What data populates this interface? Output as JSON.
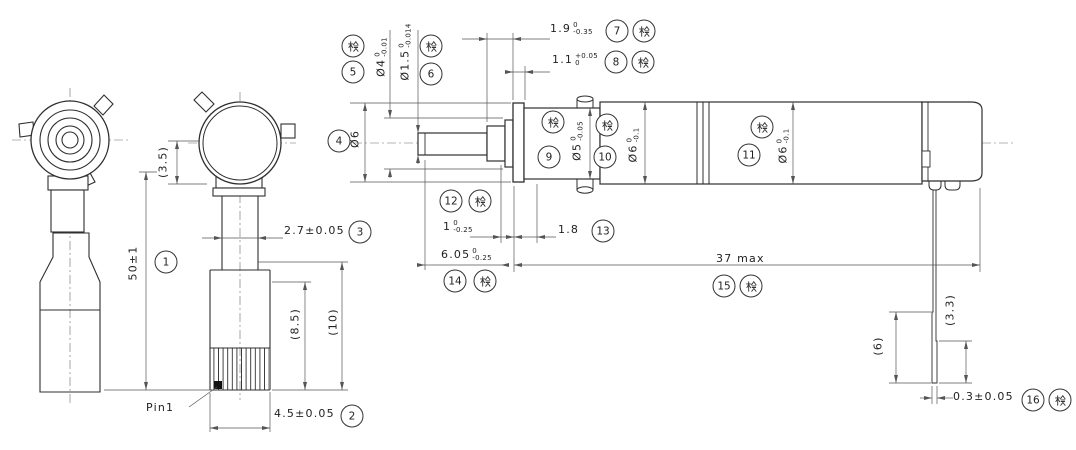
{
  "drawing": {
    "inspection_mark": "検",
    "pin_label": "Pin1",
    "dimensions": {
      "d1": {
        "balloon": "1",
        "value": "50±1"
      },
      "d2": {
        "balloon": "2",
        "value": "4.5±0.05"
      },
      "d3": {
        "balloon": "3",
        "value": "2.7±0.05"
      },
      "d4": {
        "balloon": "4",
        "value": "Ø6"
      },
      "d5": {
        "balloon": "5",
        "value": "Ø4",
        "tol_upper": "0",
        "tol_lower": "-0.01",
        "inspection": true
      },
      "d6": {
        "balloon": "6",
        "value": "Ø1.5",
        "tol_upper": "0",
        "tol_lower": "-0.014",
        "inspection": true
      },
      "d7": {
        "balloon": "7",
        "value": "1.9",
        "tol_upper": "0",
        "tol_lower": "-0.35",
        "inspection": true
      },
      "d8": {
        "balloon": "8",
        "value": "1.1",
        "tol_upper": "+0.05",
        "tol_lower": "0",
        "inspection": true
      },
      "d9": {
        "balloon": "9",
        "value": "Ø5",
        "tol_upper": "0",
        "tol_lower": "-0.05",
        "inspection": true
      },
      "d10": {
        "balloon": "10",
        "value": "Ø6",
        "tol_upper": "0",
        "tol_lower": "-0.1",
        "inspection": true
      },
      "d11": {
        "balloon": "11",
        "value": "Ø6",
        "tol_upper": "0",
        "tol_lower": "-0.1",
        "inspection": true
      },
      "d12": {
        "balloon": "12",
        "value": "1",
        "tol_upper": "0",
        "tol_lower": "-0.25",
        "inspection": true
      },
      "d13": {
        "balloon": "13",
        "value": "1.8"
      },
      "d14": {
        "balloon": "14",
        "value": "6.05",
        "tol_upper": "0",
        "tol_lower": "-0.25",
        "inspection": true
      },
      "d15": {
        "balloon": "15",
        "value": "37 max",
        "inspection": true
      },
      "d16": {
        "balloon": "16",
        "value": "0.3±0.05",
        "inspection": true
      }
    },
    "references": {
      "r3_5": {
        "value": "(3.5)"
      },
      "r8_5": {
        "value": "(8.5)"
      },
      "r10": {
        "value": "(10)"
      },
      "r6": {
        "value": "(6)"
      },
      "r3_3": {
        "value": "(3.3)"
      }
    }
  }
}
